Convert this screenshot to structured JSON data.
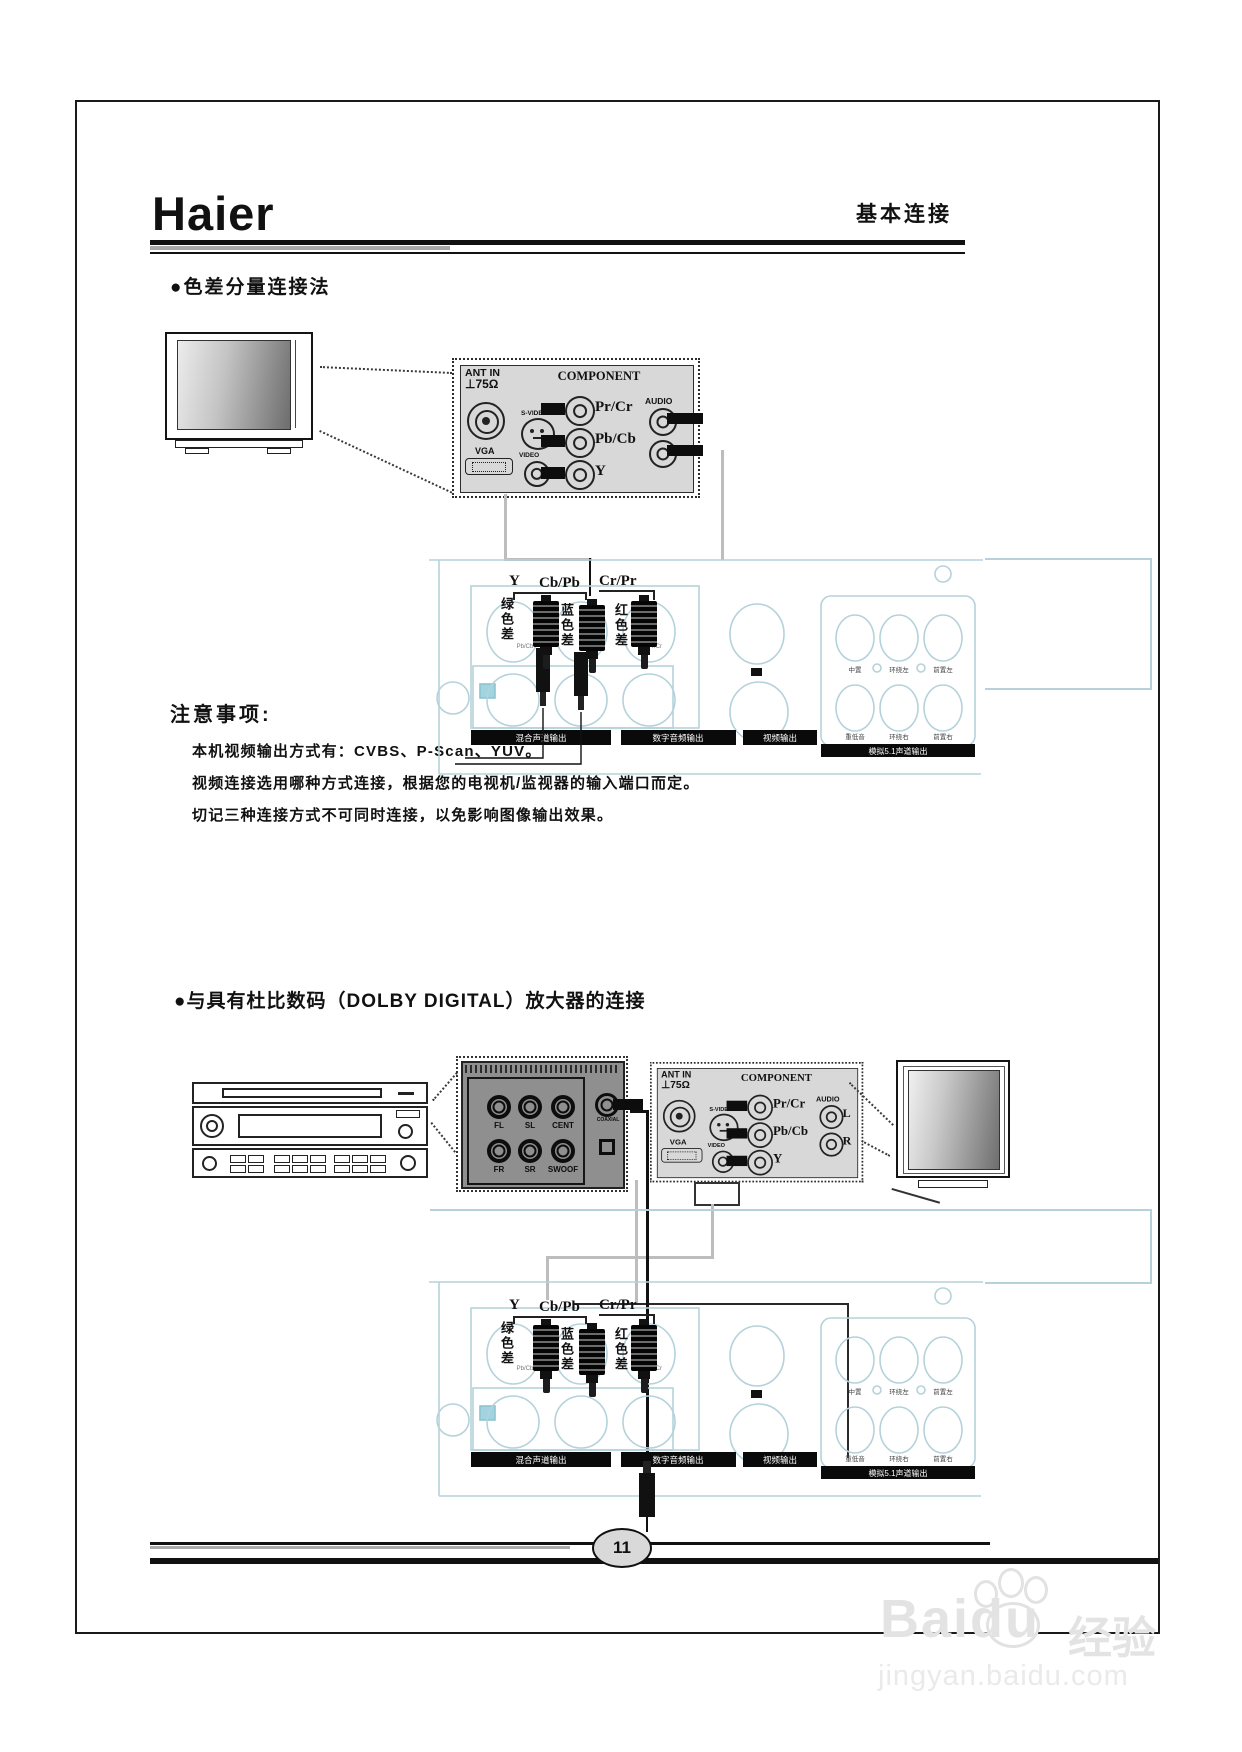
{
  "colors": {
    "panel_gray": "#d8d8d8",
    "dark_panel": "#8f8f8f",
    "line_cyan": "#b5d2da",
    "teal_square": "#9fd4e0"
  },
  "header": {
    "logo": "Haier",
    "title": "基本连接"
  },
  "sections": {
    "s1_heading": "●色差分量连接法",
    "s2_heading": "●与具有杜比数码（DOLBY DIGITAL）放大器的连接"
  },
  "component_panel": {
    "ant_in": "ANT IN",
    "impedance": "⊥75Ω",
    "title": "COMPONENT",
    "pr": "Pr/Cr",
    "pb": "Pb/Cb",
    "y": "Y",
    "audio": "AUDIO",
    "l": "L",
    "r": "R",
    "s_video": "S-VIDEO",
    "video": "VIDEO",
    "vga": "VGA"
  },
  "plug_labels": {
    "y": "Y",
    "y_cn": "绿色差",
    "cb": "Cb/Pb",
    "cb_cn": "蓝色差",
    "cr": "Cr/Pr",
    "cr_cn": "红色差"
  },
  "dvd_panel": {
    "cap_pb": "Pb/Cb",
    "cap_pr": "Pr/Cr",
    "strip1": "混合声道输出",
    "strip2": "数字音频输出",
    "strip3": "视频输出",
    "strip51": "模拟5.1声道输出",
    "ch_center": "中置",
    "ch_sl": "环绕左",
    "ch_fl": "前置左",
    "ch_sub": "重低音",
    "ch_sr": "环绕右",
    "ch_fr": "前置右"
  },
  "notes": {
    "heading": "注意事项:",
    "line1": "本机视频输出方式有：CVBS、P-Scan、YUV。",
    "line2": "视频连接选用哪种方式连接，根据您的电视机/监视器的输入端口而定。",
    "line3": "切记三种连接方式不可同时连接，以免影响图像输出效果。"
  },
  "amp_jacks": {
    "fl": "FL",
    "sl": "SL",
    "cent": "CENT",
    "fr": "FR",
    "sr": "SR",
    "swoof": "SWOOF",
    "coaxial": "COAXIAL"
  },
  "footer": {
    "page_number": "11"
  },
  "watermark": {
    "brand": "Baidu",
    "suffix": "经验",
    "url": "jingyan.baidu.com"
  }
}
